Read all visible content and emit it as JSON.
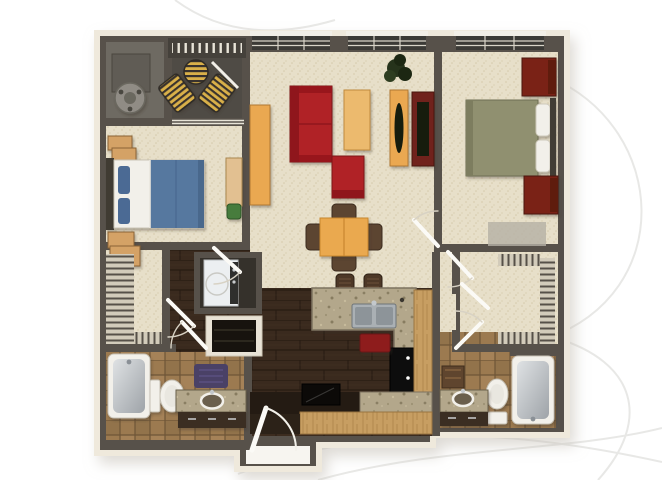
{
  "scene": {
    "type": "3d-floor-plan-rendering",
    "view": "top-down dollhouse view of a furnished apartment",
    "layout": "two-bedroom, two-bathroom apartment: balcony and utility room top-left, open living/dining room center, right bedroom, left bedroom, galley kitchen with breakfast bar, two walk-in closets, laundry closet, entry porch bottom-center",
    "background": "#ffffff"
  },
  "palette": {
    "wallDark": "#57514a",
    "wallTop": "#6e685f",
    "cream": "#efe9dc",
    "carpet": "#e7dfc9",
    "balconyFloor": "#4f4b45",
    "utilityFloor": "#6e6a62",
    "hardwood": "#3a2a1e",
    "tile": "#9c7a50",
    "granite": "#b3a78b",
    "woodCabinet": "#c79e62",
    "counterDark": "#241b13",
    "sofaRed": "#b02025",
    "sofaRedDark": "#8f181d",
    "coffeeTableTan": "#ecba6e",
    "diningOrange": "#eaa94f",
    "consoleOrange": "#eaa851",
    "tvCabinetBrown": "#6f241b",
    "screenDark": "#161c11",
    "bedBlue": "#56789f",
    "pillowBlue": "#4b6b94",
    "sheetWhite": "#f2f0ea",
    "bedOlive": "#90906f",
    "cherryWood": "#7a2419",
    "nightstandTan": "#d4a266",
    "deskTan": "#e2c091",
    "plantGreen": "#26331b",
    "loungeYellow": "#d8ae42",
    "loungeDark": "#37332d",
    "stainless": "#aab0b4",
    "fixtureWhite": "#f2f0ea",
    "matPurple": "#4a4166",
    "chairGreen": "#477c3e",
    "diningChairWood": "#5c4531",
    "stoolBrown": "#4d3827",
    "towelRed": "#8e1f1f",
    "fridgeBlack": "#0e0c0a",
    "washerWhite": "#eceff1",
    "benchBrown": "#5f452e",
    "rugGray": "#b5b0a5",
    "doorLeaf": "#fbfaf6",
    "swingArc": "#d8d2c4",
    "swirl": "#e8e8e6",
    "porch": "#f7f5f0",
    "windowGlass": "#3b3a36",
    "windowFrame": "#f2efe7",
    "hvacGray": "#908c85"
  },
  "rooms": [
    {
      "name": "utility-room"
    },
    {
      "name": "balcony"
    },
    {
      "name": "living-room"
    },
    {
      "name": "dining-area"
    },
    {
      "name": "bedroom-left"
    },
    {
      "name": "bedroom-right"
    },
    {
      "name": "kitchen"
    },
    {
      "name": "entry-hall"
    },
    {
      "name": "bathroom-left"
    },
    {
      "name": "bathroom-right"
    },
    {
      "name": "walk-in-closet-left"
    },
    {
      "name": "walk-in-closet-right"
    },
    {
      "name": "laundry-closet"
    },
    {
      "name": "entry-porch"
    }
  ]
}
